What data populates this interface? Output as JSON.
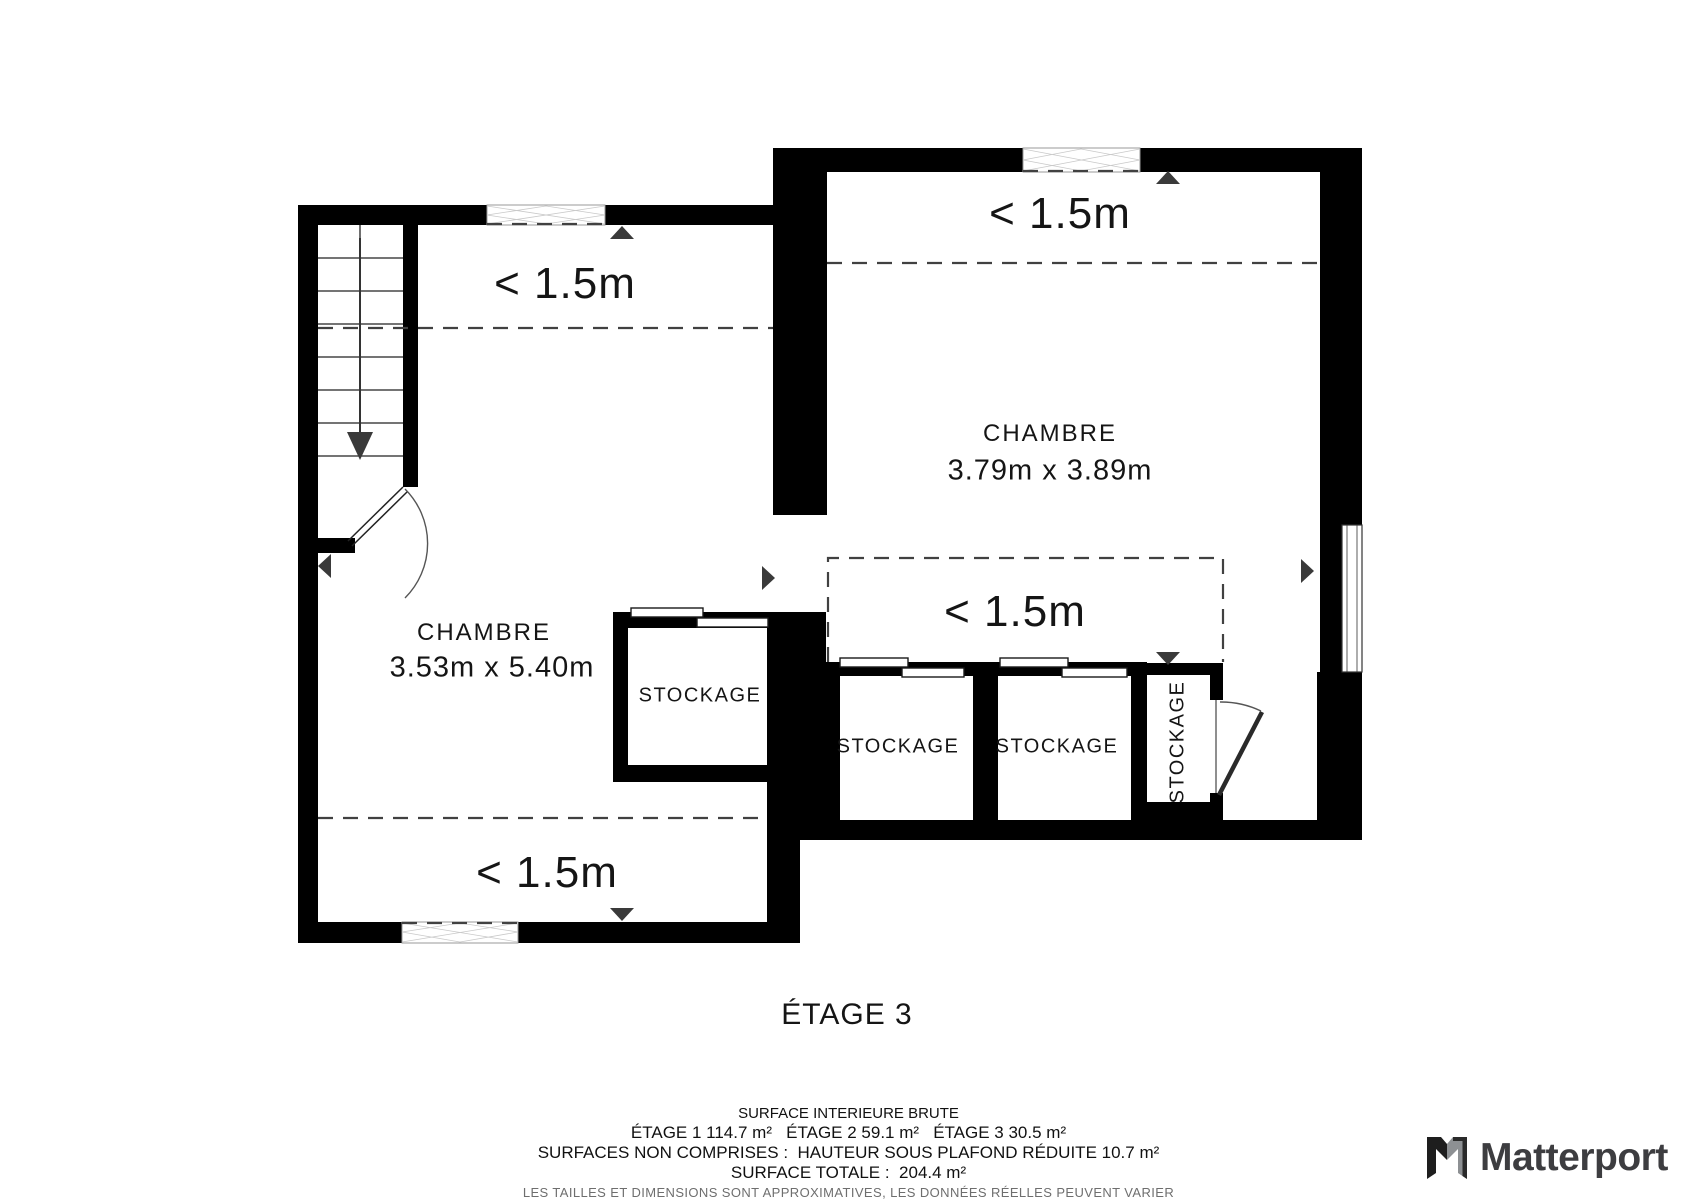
{
  "plan": {
    "title": "ÉTAGE 3",
    "low_ceiling_label": "< 1.5m",
    "storage_label": "STOCKAGE",
    "rooms": {
      "left": {
        "name": "CHAMBRE",
        "dims": "3.53m x 5.40m"
      },
      "right": {
        "name": "CHAMBRE",
        "dims": "3.79m x 3.89m"
      }
    }
  },
  "footer": {
    "line1": "SURFACE INTERIEURE BRUTE",
    "line2": "ÉTAGE 1 114.7 m²   ÉTAGE 2 59.1 m²   ÉTAGE 3 30.5 m²",
    "line3": "SURFACES NON COMPRISES :  HAUTEUR SOUS PLAFOND RÉDUITE 10.7 m²",
    "line4": "SURFACE TOTALE :  204.4 m²",
    "disclaimer": "LES TAILLES ET DIMENSIONS SONT APPROXIMATIVES, LES DONNÉES RÉELLES PEUVENT VARIER"
  },
  "branding": {
    "name": "Matterport"
  }
}
